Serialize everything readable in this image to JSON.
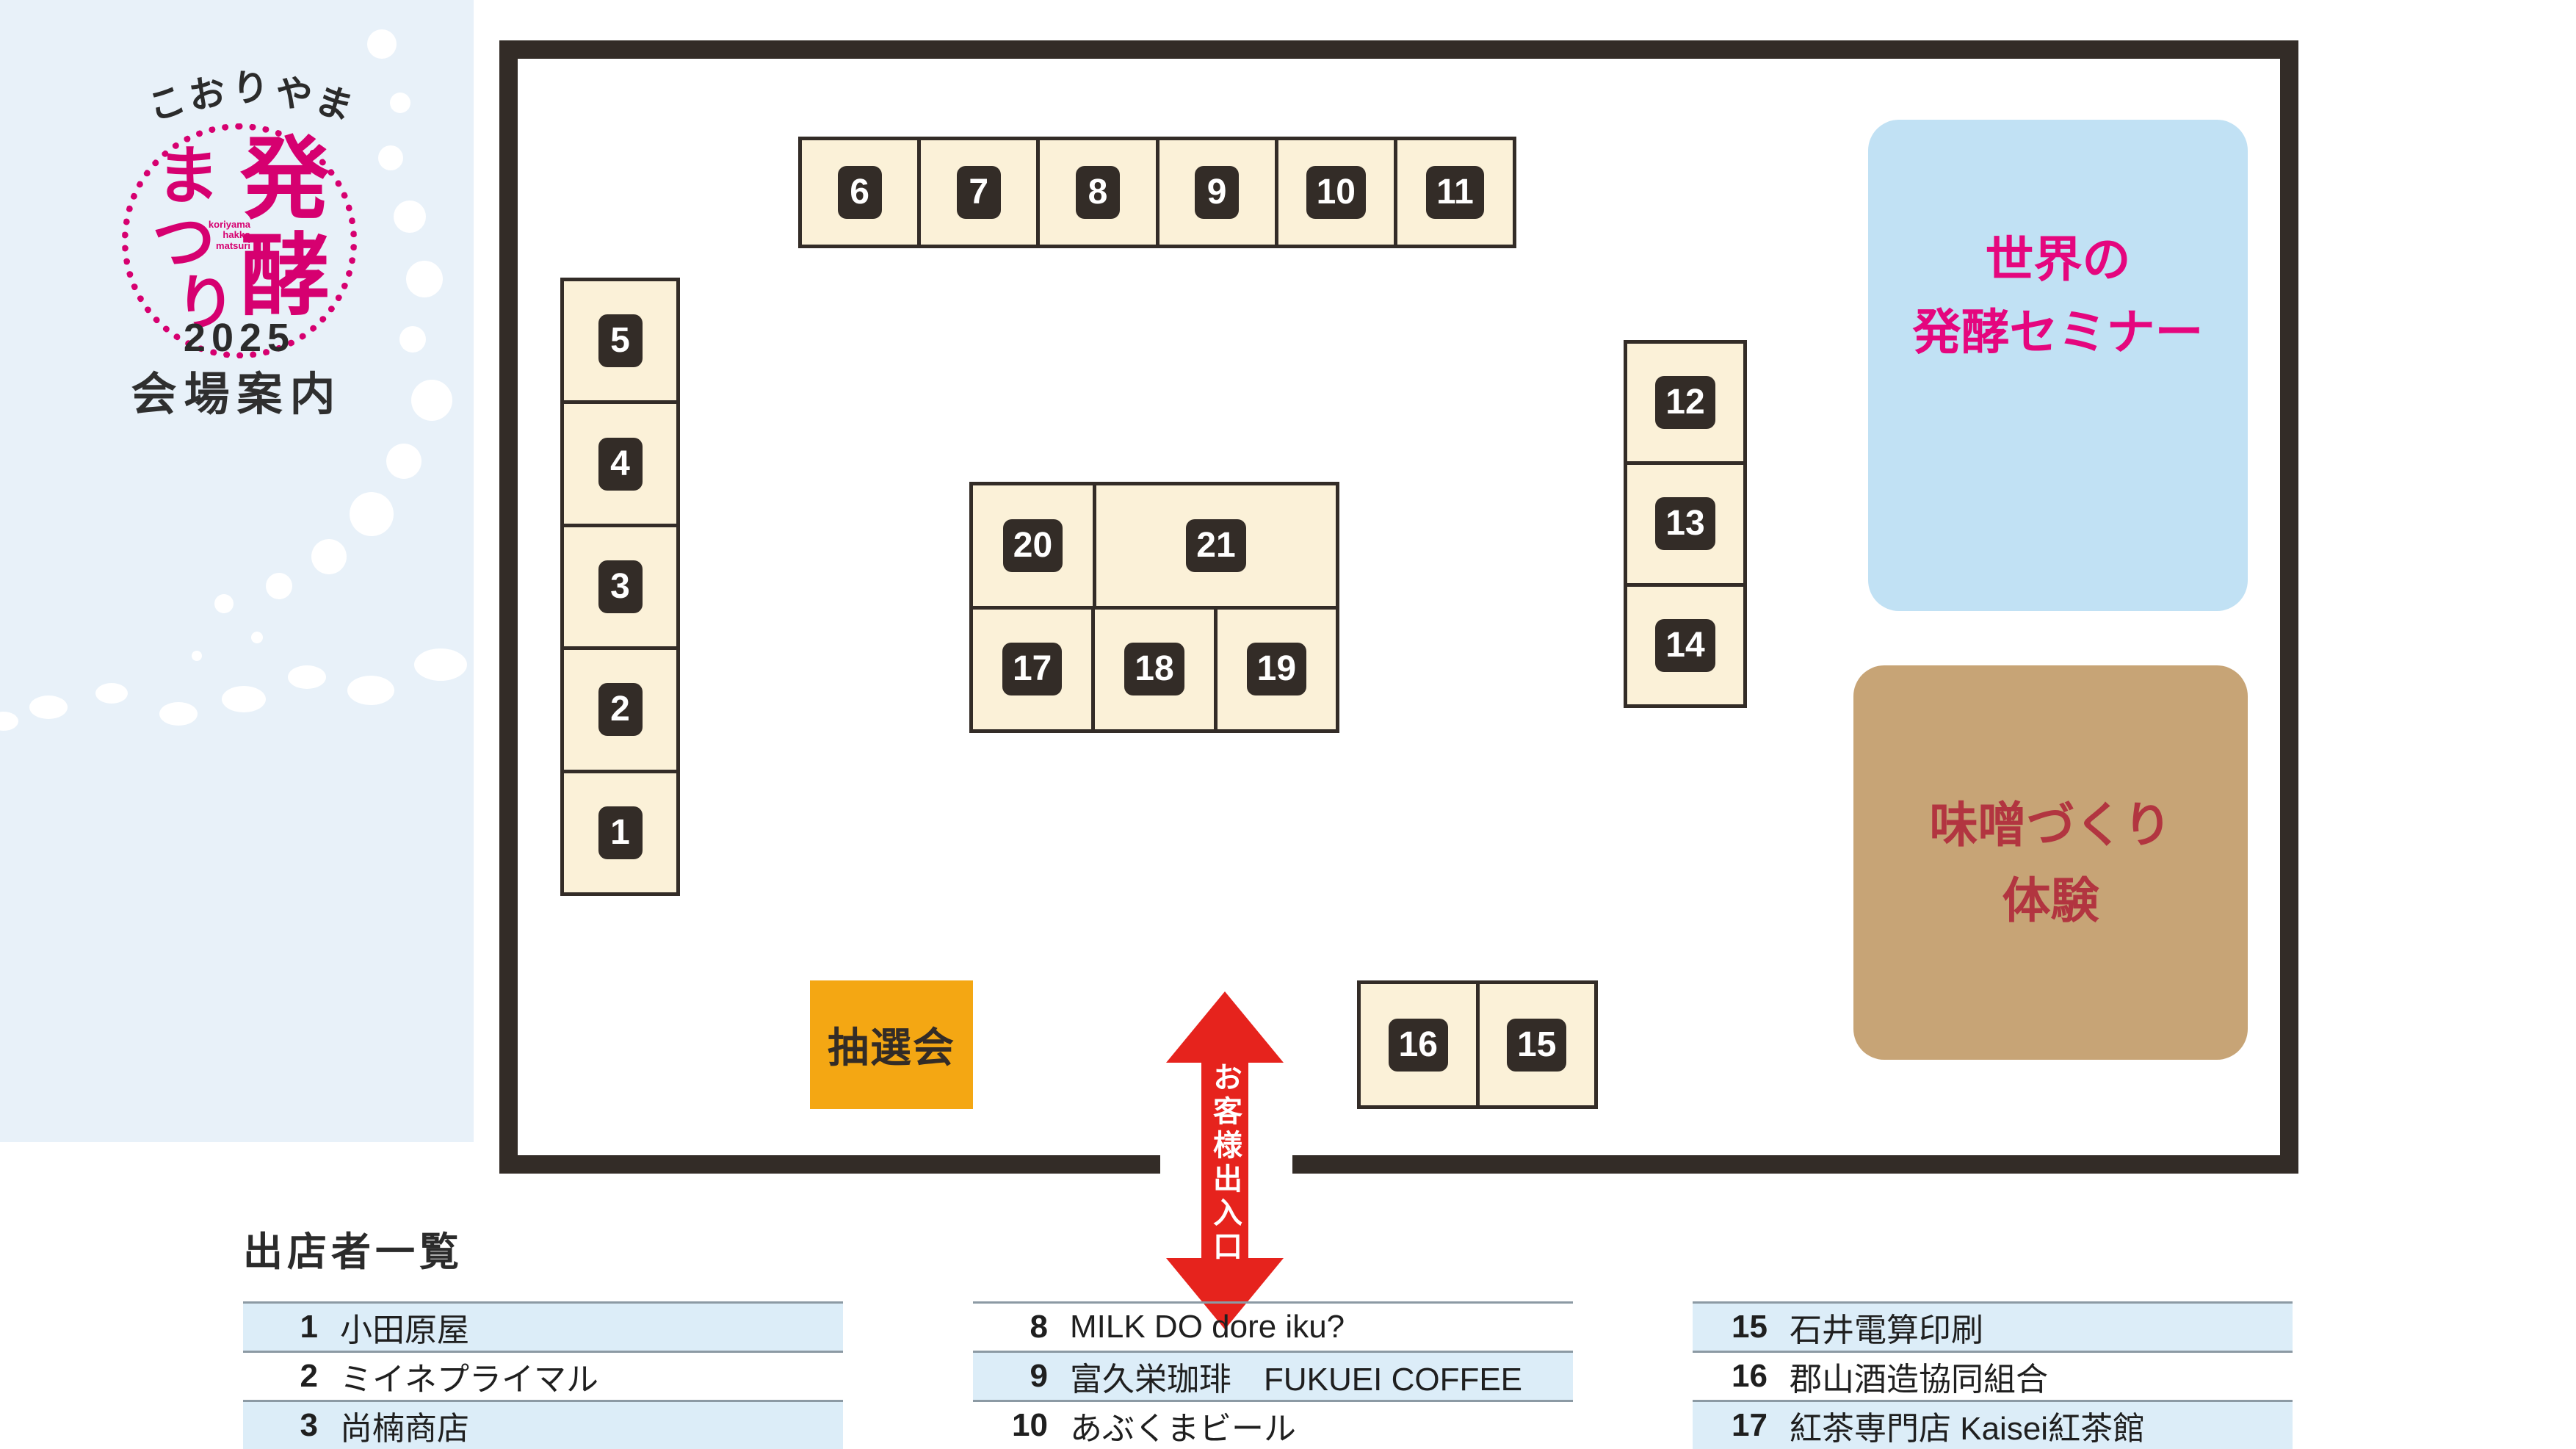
{
  "sidebar": {
    "logo": {
      "arc_text": "こおりやま",
      "hakko_text": "発酵",
      "matsuri_text": "まつり",
      "sub_lines": [
        "koriyama",
        "hakko",
        "matsuri"
      ],
      "year": "2025"
    },
    "subtitle": "会場案内"
  },
  "map": {
    "top_row": [
      "6",
      "7",
      "8",
      "9",
      "10",
      "11"
    ],
    "left_column": [
      "5",
      "4",
      "3",
      "2",
      "1"
    ],
    "center_top": [
      "20",
      "21"
    ],
    "center_bottom": [
      "17",
      "18",
      "19"
    ],
    "right_column": [
      "12",
      "13",
      "14"
    ],
    "bottom_pair": [
      "16",
      "15"
    ],
    "lottery_label": "抽選会",
    "entrance_label": "お客様出入口",
    "seminar_lines": [
      "世界の",
      "発酵セミナー"
    ],
    "miso_lines": [
      "味噌づくり",
      "体験"
    ]
  },
  "vendors": {
    "title": "出店者一覧",
    "columns": [
      [
        {
          "no": "1",
          "name": "小田原屋"
        },
        {
          "no": "2",
          "name": "ミイネプライマル"
        },
        {
          "no": "3",
          "name": "尚楠商店"
        }
      ],
      [
        {
          "no": "8",
          "name": "MILK DO dore iku?"
        },
        {
          "no": "9",
          "name": "富久栄珈琲　FUKUEI COFFEE"
        },
        {
          "no": "10",
          "name": "あぶくまビール"
        }
      ],
      [
        {
          "no": "15",
          "name": "石井電算印刷"
        },
        {
          "no": "16",
          "name": "郡山酒造協同組合"
        },
        {
          "no": "17",
          "name": "紅茶専門店 Kaisei紅茶館"
        }
      ]
    ]
  },
  "colors": {
    "sidebar_bg": "#e8f1f9",
    "logo_pink": "#d60070",
    "booth_fill": "#fbf1d8",
    "line_dark": "#332c27",
    "seminar_bg": "#c1e1f4",
    "seminar_text": "#e5067e",
    "miso_bg": "#c7a476",
    "miso_text": "#b23540",
    "lottery_bg": "#f4a713",
    "arrow_red": "#e6231d",
    "table_row_blue": "#dcedf8"
  }
}
